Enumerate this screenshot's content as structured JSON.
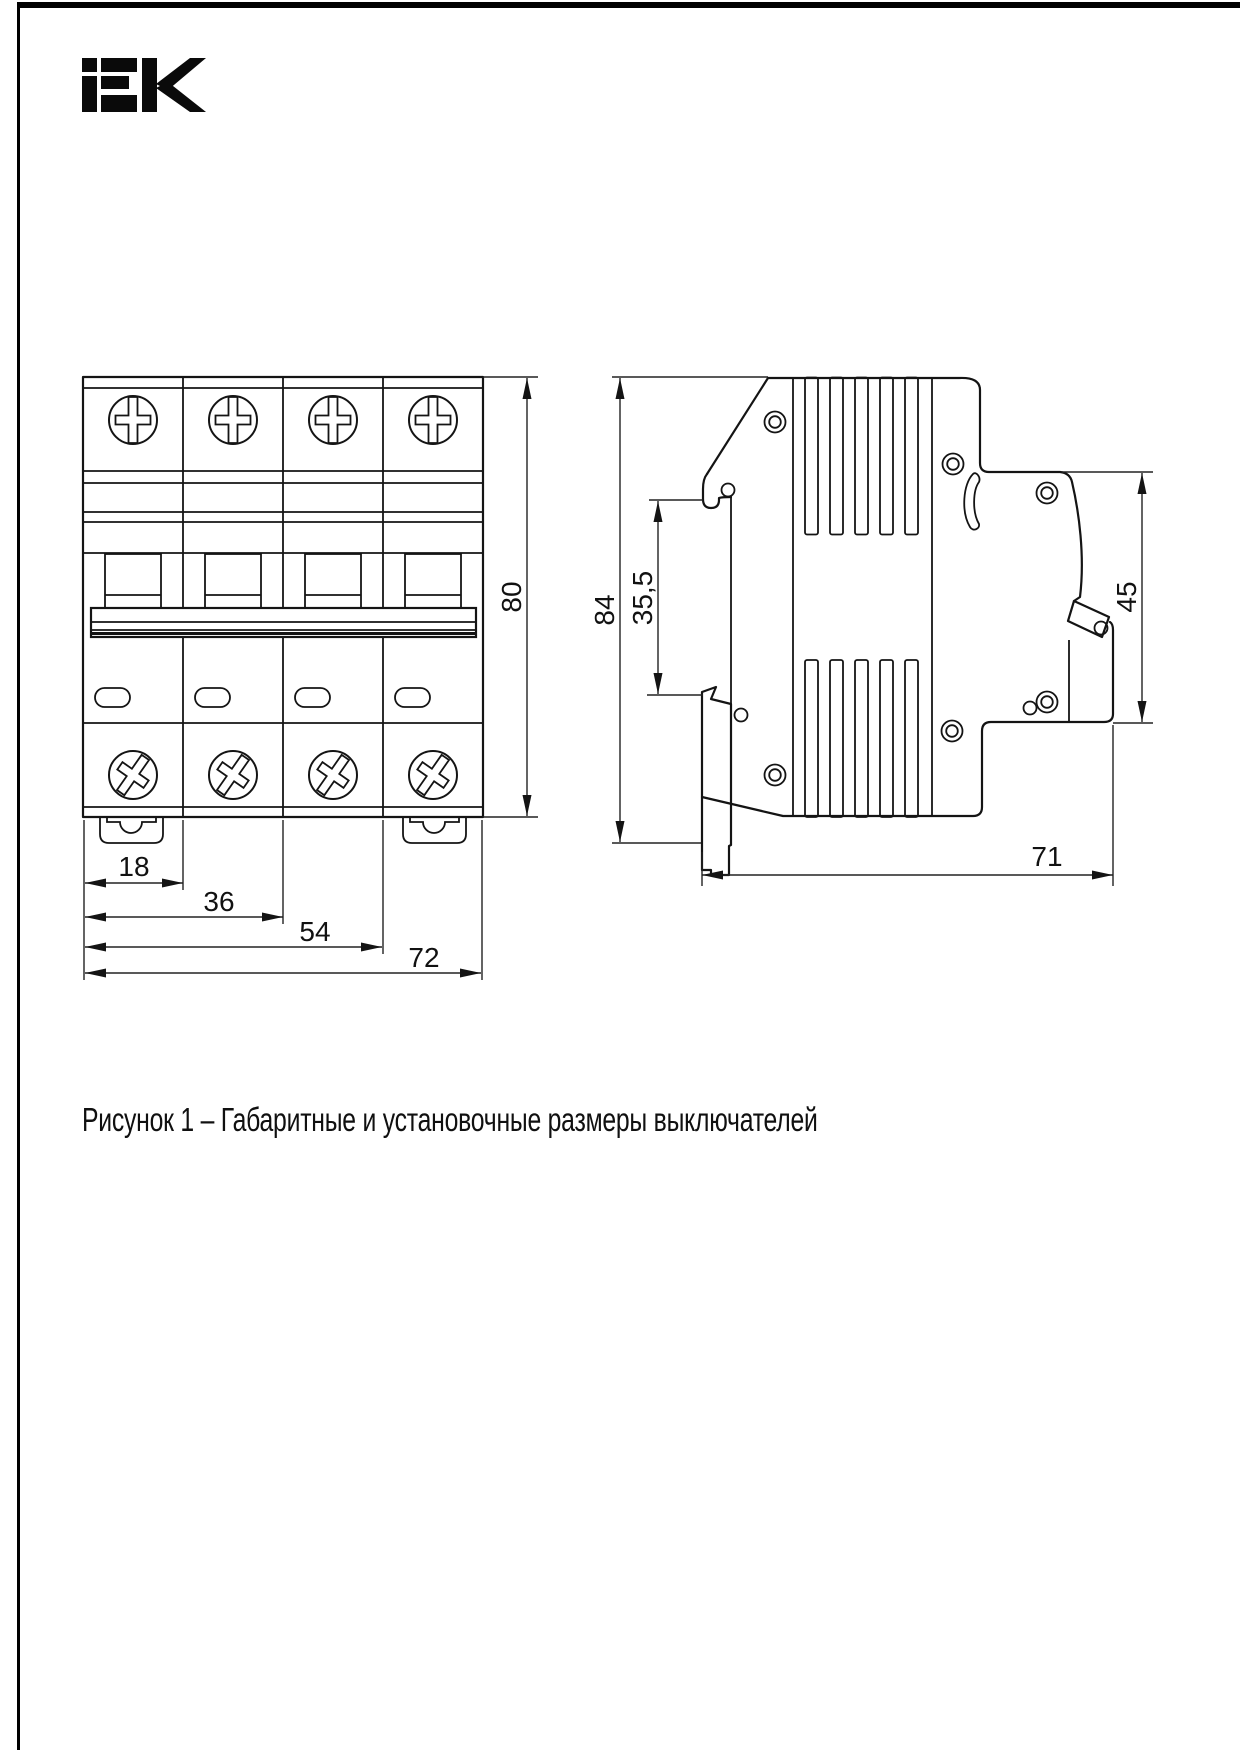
{
  "page": {
    "caption": "Рисунок 1 – Габаритные и установочные размеры выключателей"
  },
  "logo": {
    "text": "IEK"
  },
  "front_view": {
    "label": "front view of 4-pole circuit breaker",
    "dims": {
      "module_width": "18",
      "two_modules": "36",
      "three_modules": "54",
      "total_width": "72",
      "height": "80"
    }
  },
  "side_view": {
    "label": "side view of circuit breaker",
    "dims": {
      "height": "84",
      "rail_to_top": "35,5",
      "front_height": "45",
      "depth": "71"
    }
  }
}
